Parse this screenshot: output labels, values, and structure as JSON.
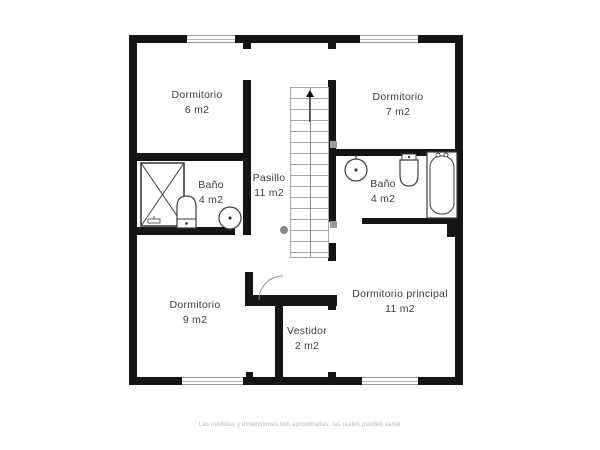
{
  "plan": {
    "rooms": [
      {
        "name": "Dormitorio",
        "area": "6 m2"
      },
      {
        "name": "Dormitorio",
        "area": "7 m2"
      },
      {
        "name": "Baño",
        "area": "4 m2"
      },
      {
        "name": "Pasillo",
        "area": "11 m2"
      },
      {
        "name": "Baño",
        "area": "4 m2"
      },
      {
        "name": "Dormitorio",
        "area": "9 m2"
      },
      {
        "name": "Vestidor",
        "area": "2 m2"
      },
      {
        "name": "Dormitorio principal",
        "area": "11 m2"
      }
    ],
    "fixtures": [
      "shower-icon",
      "toilet-icon",
      "sink-icon",
      "sink-icon",
      "toilet-icon",
      "bathtub-icon",
      "stairs-up-arrow-icon"
    ],
    "disclaimer": "Las medidas y dimensiones son aproximadas, las reales pueden variar",
    "colors": {
      "wall": "#151515",
      "fixture_outline": "#3d3d3d",
      "stair_line": "#a8a8a8",
      "label_text": "#3c3c3c",
      "disclaimer_text": "#b8b8b8",
      "background": "#ffffff"
    }
  }
}
